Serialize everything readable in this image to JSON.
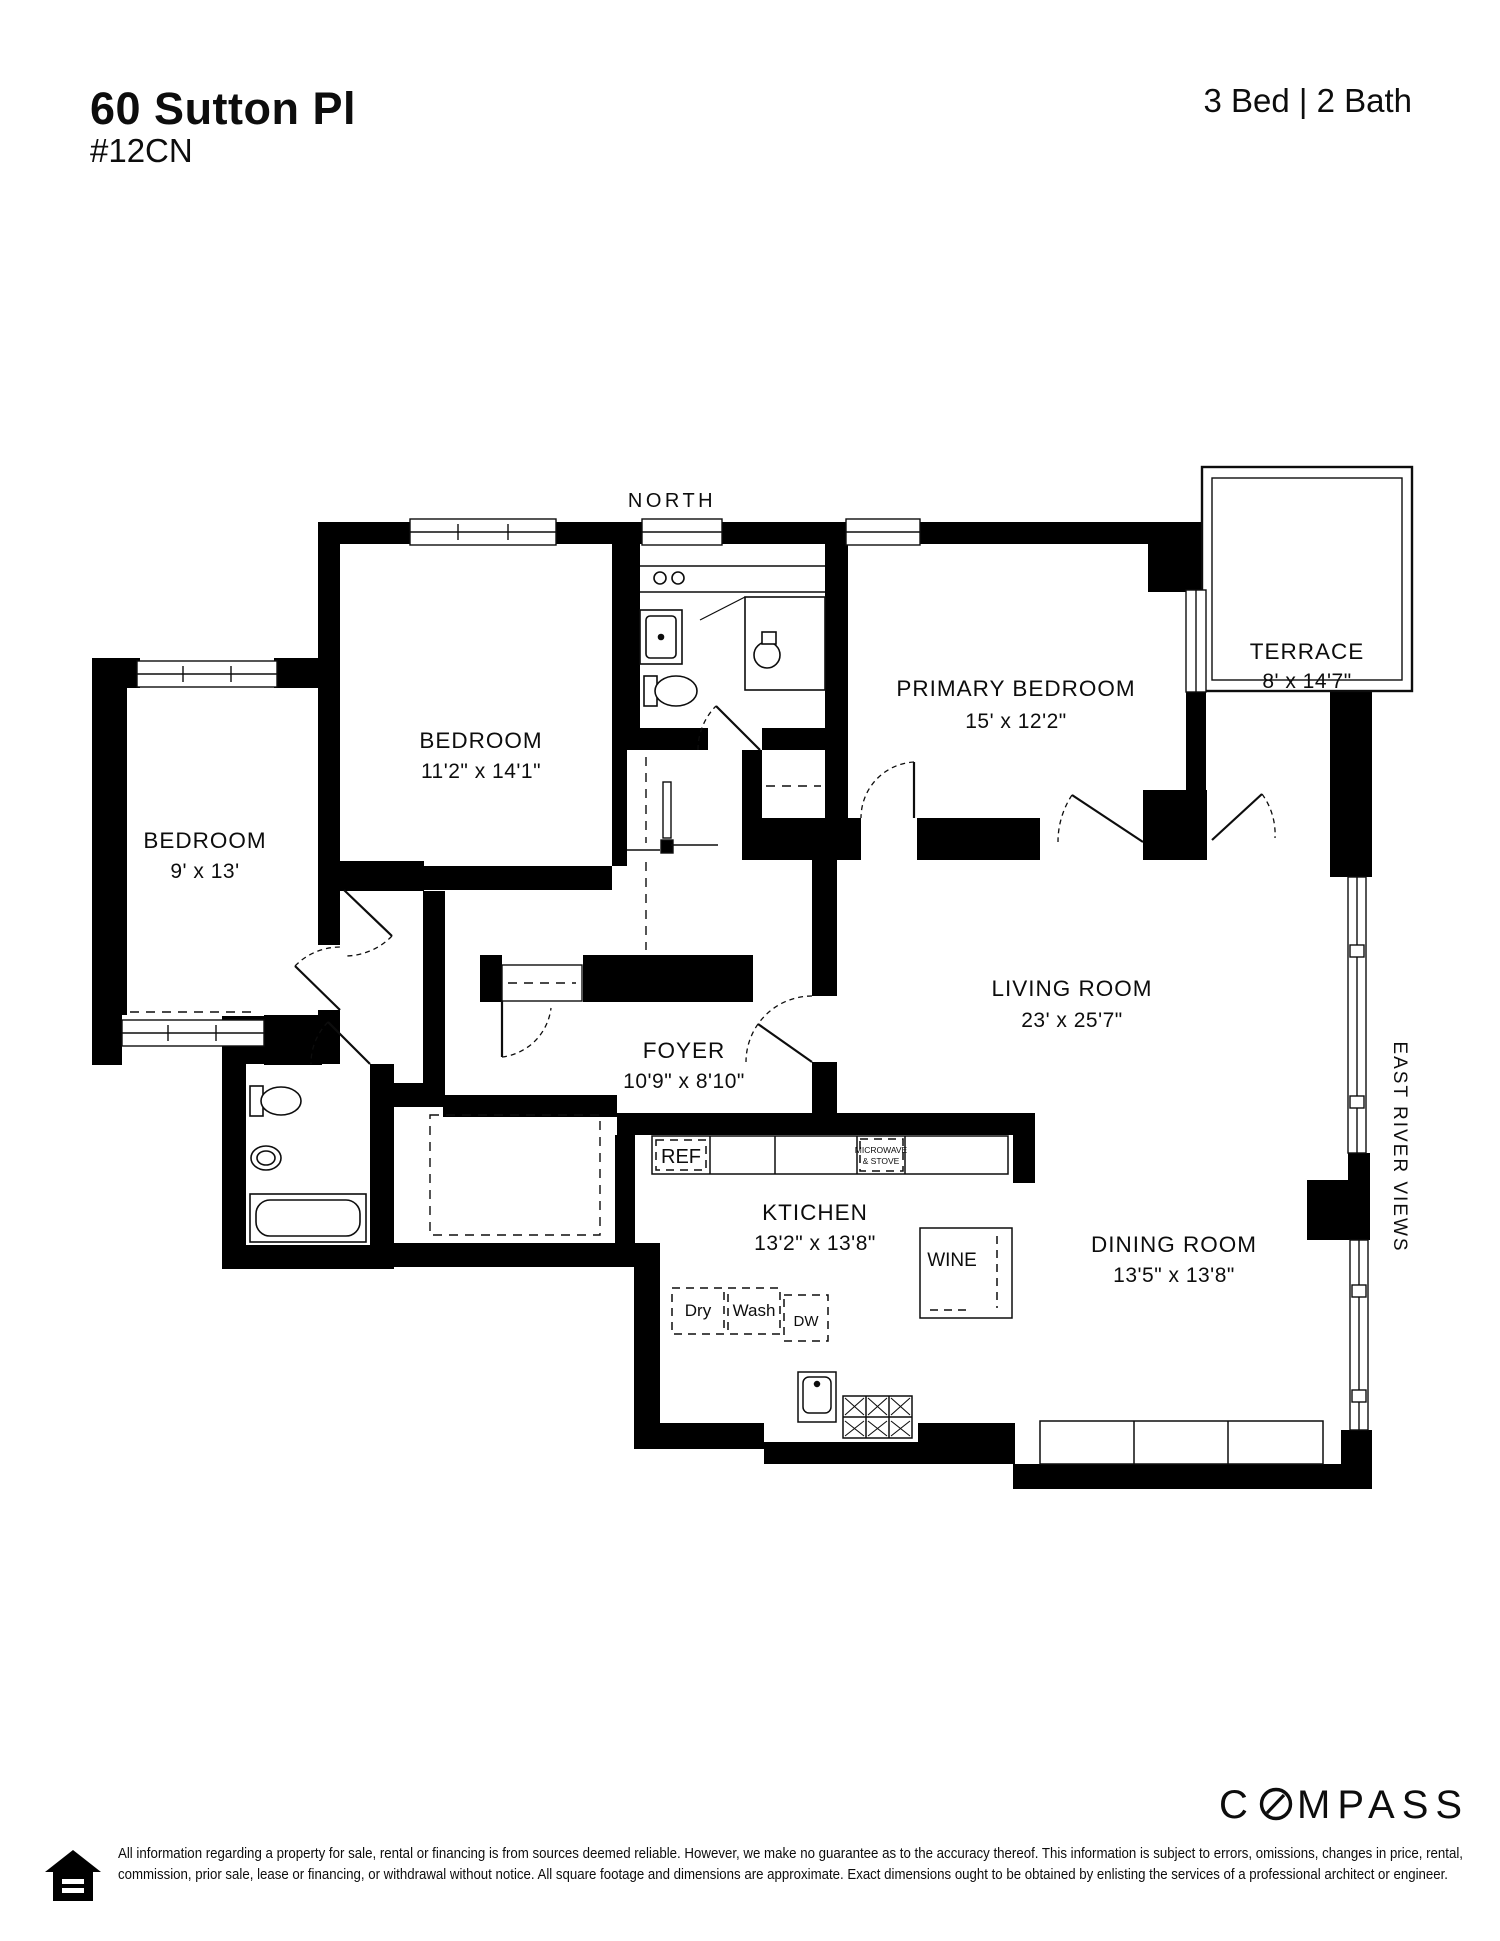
{
  "header": {
    "address": "60 Sutton Pl",
    "unit": "#12CN",
    "bed_bath": "3 Bed | 2 Bath"
  },
  "plan": {
    "north_label": "NORTH",
    "east_label": "EAST RIVER VIEWS",
    "rooms": [
      {
        "name": "TERRACE",
        "dims": "8' x 14'7\""
      },
      {
        "name": "PRIMARY BEDROOM",
        "dims": "15' x 12'2\""
      },
      {
        "name": "BEDROOM",
        "dims": "11'2\" x 14'1\""
      },
      {
        "name": "BEDROOM",
        "dims": "9' x 13'"
      },
      {
        "name": "LIVING ROOM",
        "dims": "23' x 25'7\""
      },
      {
        "name": "FOYER",
        "dims": "10'9\" x 8'10\""
      },
      {
        "name": "KTICHEN",
        "dims": "13'2\" x 13'8\""
      },
      {
        "name": "DINING ROOM",
        "dims": "13'5\" x 13'8\""
      }
    ],
    "fixtures": {
      "ref": "REF",
      "microwave_line1": "MICROWAVE",
      "microwave_line2": "& STOVE",
      "wine": "WINE",
      "dry": "Dry",
      "wash": "Wash",
      "dw": "DW"
    }
  },
  "footer": {
    "brand": "COMPASS",
    "brand_c": "C",
    "brand_rest": "MPASS",
    "disclaimer_line1": "All information regarding a property for sale, rental or financing is from sources deemed reliable. However, we make no guarantee as to the accuracy thereof. This information is subject to errors, omissions, changes in price, rental,",
    "disclaimer_line2": "commission, prior sale, lease or financing, or withdrawal without notice. All square footage and dimensions are approximate. Exact dimensions ought to be obtained by enlisting the services of a professional architect or engineer."
  },
  "colors": {
    "wall": "#000000",
    "background": "#ffffff",
    "line": "#0d0d0d"
  }
}
